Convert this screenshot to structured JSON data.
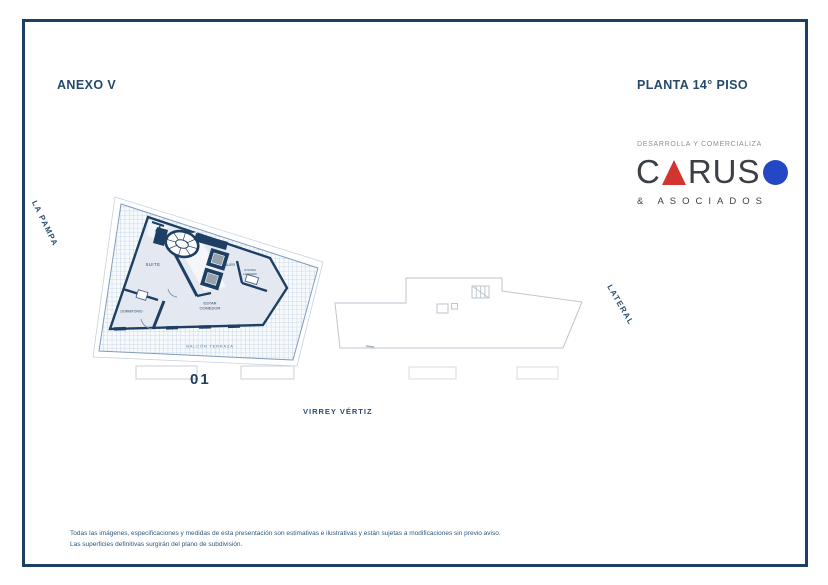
{
  "page": {
    "annex_title": "ANEXO V",
    "sheet_title": "PLANTA 14° PISO"
  },
  "logo": {
    "tagline": "DESARROLLA Y COMERCIALIZA",
    "name_c": "C",
    "name_rus": "RUS",
    "subtitle": "& ASOCIADOS",
    "triangle_color": "#d23430",
    "circle_color": "#2447c5"
  },
  "plan": {
    "unit_number": "01",
    "street_bottom": "VIRREY VÉRTIZ",
    "street_left": "LA PAMPA",
    "street_right": "LATERAL",
    "rooms": {
      "suite": "SUITE",
      "dormitorio": "DORMITORIO",
      "estar_line1": "ESTAR",
      "estar_line2": "COMEDOR",
      "palier": "PALIER",
      "cocina": "COCINA",
      "lavadero": "LAVADERO",
      "balcon": "BALCÓN TERRAZA"
    }
  },
  "disclaimer": {
    "line1": "Todas las imágenes, especificaciones y medidas de esta presentación son estimativas e ilustrativas y están sujetas a modificaciones sin previo aviso.",
    "line2": "Las superficies definitivas surgirán del plano de subdivisión."
  },
  "colors": {
    "accent_navy": "#1d3f63",
    "heading_navy": "#25496c",
    "hatch_line": "#a6bcd4",
    "floor_fill": "#e4e8f0"
  }
}
